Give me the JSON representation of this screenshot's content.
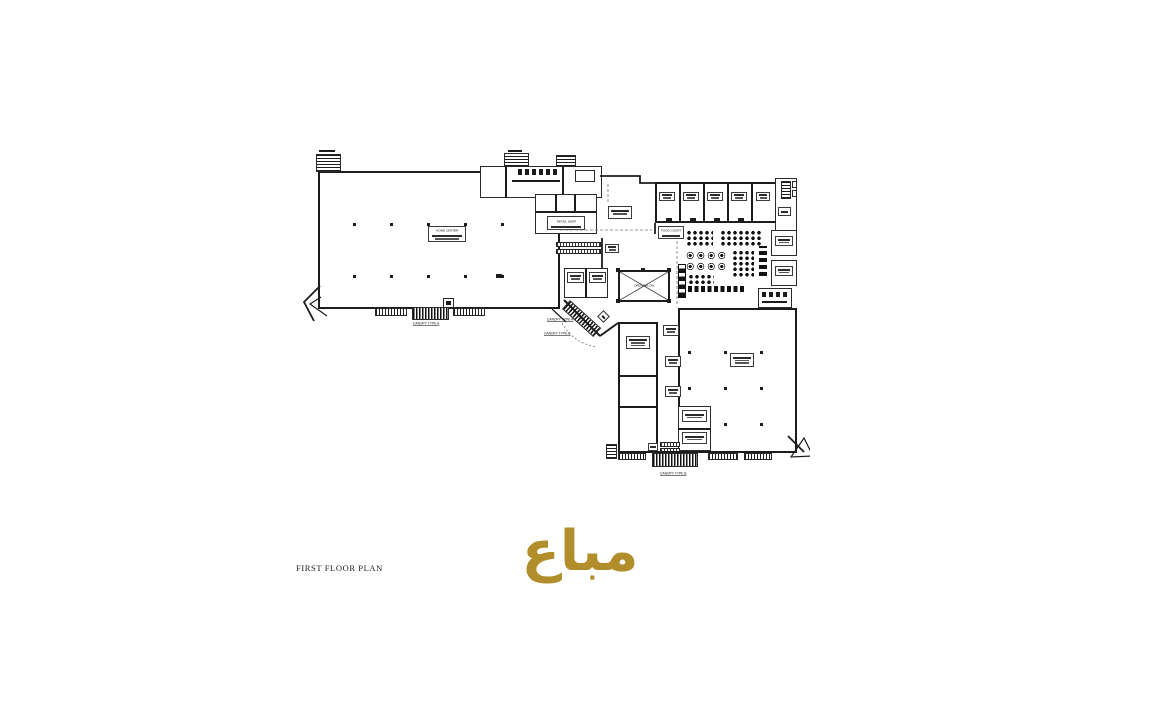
{
  "drawing": {
    "caption": "FIRST FLOOR PLAN",
    "stamp": {
      "text": "مباع",
      "color": "#b18d2b"
    }
  },
  "plan": {
    "room_labels": {
      "home_center": "HOME CENTER",
      "retail_shop": "RETAIL SHOP",
      "food_court": "FOOD COURT",
      "open_below": "OPEN BELOW"
    },
    "canopy_labels": {
      "type_a": "CANOPY TYPE A",
      "type_b": "CANOPY TYPE B"
    }
  },
  "colors": {
    "line": "#1c1c1c",
    "stamp_gold": "#b18d2b",
    "background": "#ffffff"
  }
}
